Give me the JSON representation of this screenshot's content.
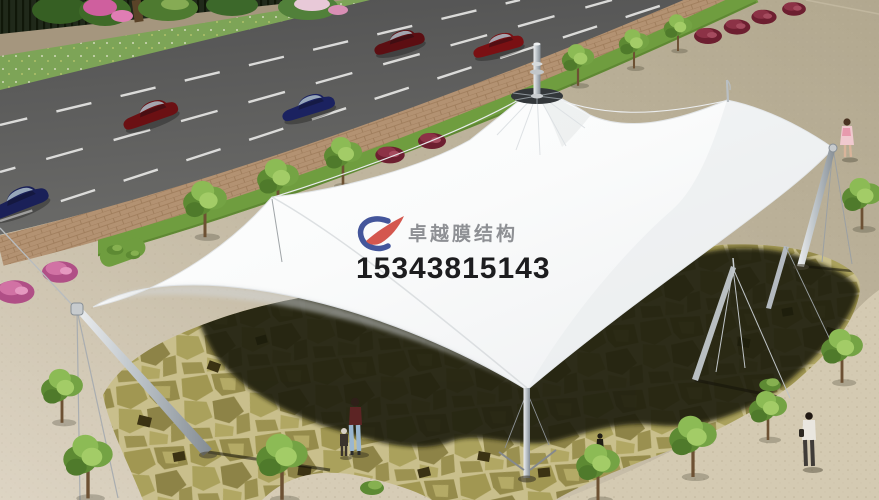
{
  "watermark": {
    "company_name": "卓越膜结构",
    "phone_number": "15343815143",
    "logo_icon": "zhuoyue-membrane-logo",
    "logo_blue": "#44569b",
    "logo_red": "#d4574e",
    "company_text_color": "#8e9094",
    "phone_text_color": "#1d1d1f"
  },
  "scene": {
    "type": "architectural-rendering",
    "subject": "white tensile membrane canopy over flagstone plaza beside a road",
    "colors": {
      "road": "#5f5f5f",
      "lane_marking": "#e9e9e7",
      "plaza": "#b7ad97",
      "plaza_light": "#dcd3c2",
      "sidewalk_brick": "#b39272",
      "grass_strip": "#6f9d3f",
      "flagstone": "#9a9156",
      "flagstone_joint": "#c9bf8c",
      "canopy_shadow": "#1c1b0e",
      "membrane": "#f7f8f9",
      "mast": "#a7adb2",
      "tree_foliage": "#74a344",
      "bush_maroon": "#6d1f30",
      "bush_pink": "#cf5f9e",
      "car_dark_red": "#6b1013",
      "car_dark_blue": "#1b2260"
    },
    "elements": {
      "cars": 5,
      "masts": 6,
      "pedestrians": 5,
      "trees": 14
    }
  }
}
